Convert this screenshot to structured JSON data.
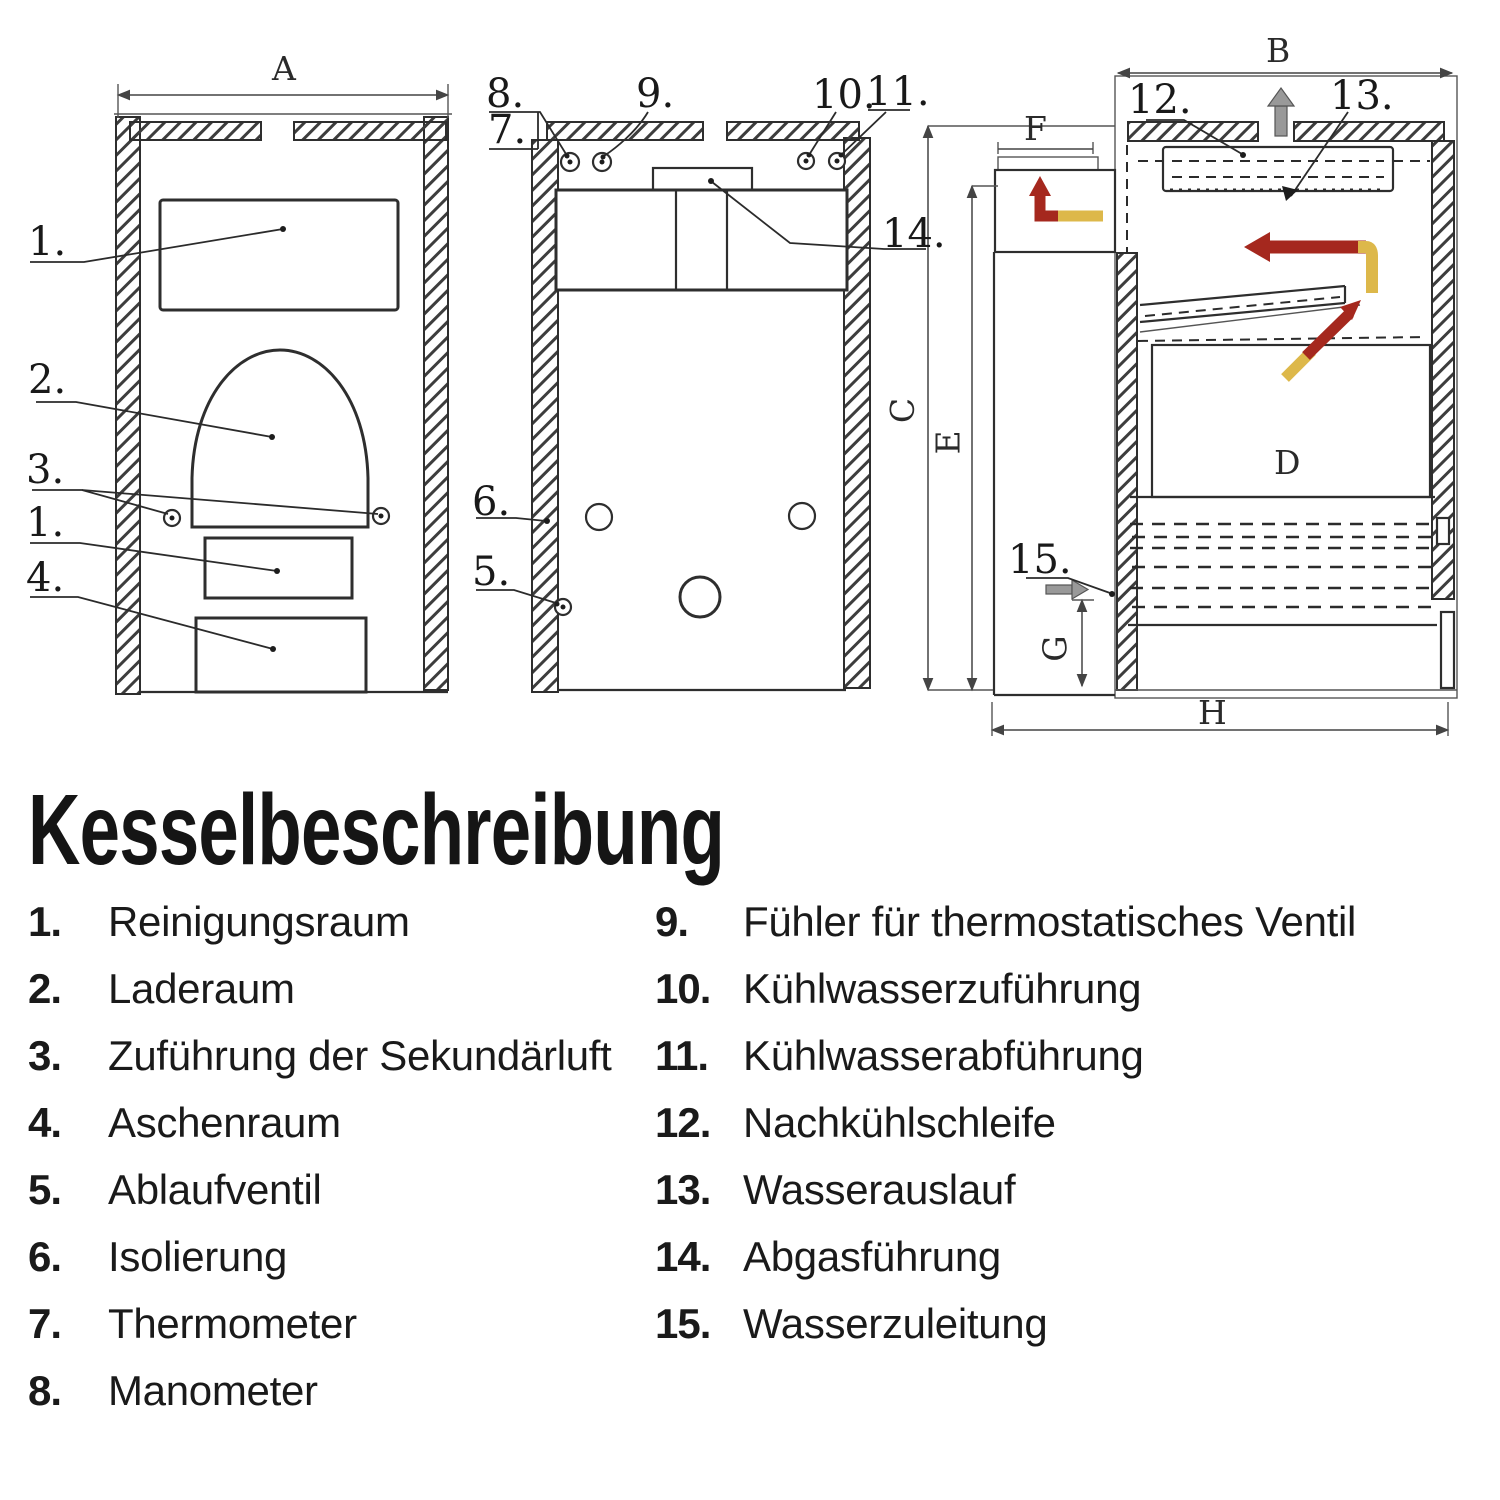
{
  "title": "Kesselbeschreibung",
  "legend": {
    "left": [
      {
        "num": "1.",
        "label": "Reinigungsraum"
      },
      {
        "num": "2.",
        "label": "Laderaum"
      },
      {
        "num": "3.",
        "label": "Zuführung der Sekundärluft"
      },
      {
        "num": "4.",
        "label": "Aschenraum"
      },
      {
        "num": "5.",
        "label": "Ablaufventil"
      },
      {
        "num": "6.",
        "label": "Isolierung"
      },
      {
        "num": "7.",
        "label": "Thermometer"
      },
      {
        "num": "8.",
        "label": "Manometer"
      }
    ],
    "right": [
      {
        "num": "9.",
        "label": "Fühler für thermostatisches Ventil"
      },
      {
        "num": "10.",
        "label": "Kühlwasserzuführung"
      },
      {
        "num": "11.",
        "label": "Kühlwasserabführung"
      },
      {
        "num": "12.",
        "label": "Nachkühlschleife"
      },
      {
        "num": "13.",
        "label": "Wasserauslauf"
      },
      {
        "num": "14.",
        "label": "Abgasführung"
      },
      {
        "num": "15.",
        "label": "Wasserzuleitung"
      }
    ]
  },
  "callouts": {
    "front": {
      "c1": "1.",
      "c2": "2.",
      "c3": "3.",
      "c1b": "1.",
      "c4": "4."
    },
    "rear": {
      "c5": "5.",
      "c6": "6.",
      "c7": "7.",
      "c8": "8.",
      "c9": "9.",
      "c10": "10.",
      "c11": "11.",
      "c14": "14."
    },
    "side": {
      "c12": "12.",
      "c13": "13.",
      "c15": "15."
    }
  },
  "dimensions": {
    "a": "A",
    "b": "B",
    "c": "C",
    "d": "D",
    "e": "E",
    "f": "F",
    "g": "G",
    "h": "H"
  },
  "colors": {
    "line": "#2e2e2e",
    "flow_red": "#a5281e",
    "flow_yellow": "#ddb84a",
    "dim_grey": "#999999"
  }
}
